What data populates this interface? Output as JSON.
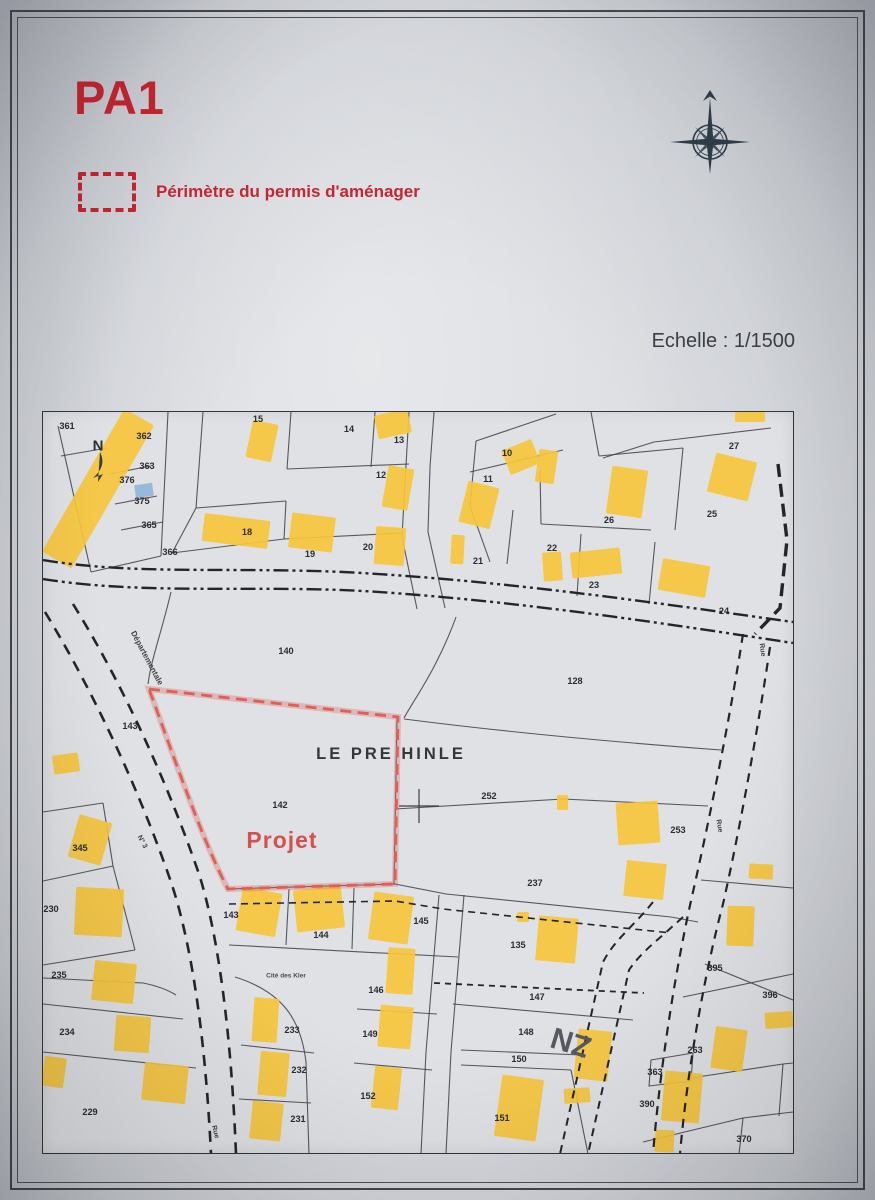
{
  "header": {
    "doc_code": "PA1",
    "legend_label": "Périmètre du permis d'aménager",
    "scale_label": "Echelle : 1/1500",
    "accent": "#c62531"
  },
  "map": {
    "width": 750,
    "height": 741,
    "ink": "#3c3e44",
    "yellow": "#f6c53c",
    "blue": "#8fb6d8",
    "red": "#dd5f57",
    "road_ink": "#24252a",
    "texts": [
      {
        "t": "LE PRE HINLE",
        "x": 348,
        "y": 342,
        "s": 16.5,
        "c": "#34363b",
        "ls": 3
      },
      {
        "t": "Projet",
        "x": 239,
        "y": 428,
        "s": 23,
        "c": "#d5514e",
        "ls": 1
      },
      {
        "t": "ZN",
        "x": 528,
        "y": 630,
        "s": 30,
        "c": "#565962",
        "rot": 197
      },
      {
        "t": "N",
        "x": 55,
        "y": 34,
        "s": 15,
        "c": "#2b2d33"
      },
      {
        "t": "Départementale",
        "x": 104,
        "y": 246,
        "s": 8,
        "c": "#3f4146",
        "rot": 62
      },
      {
        "t": "N° 3",
        "x": 99,
        "y": 430,
        "s": 7,
        "c": "#3f4146",
        "rot": 62
      },
      {
        "t": "Rue",
        "x": 719,
        "y": 238,
        "s": 7,
        "c": "#3f4146",
        "rot": 82
      },
      {
        "t": "Rue",
        "x": 676,
        "y": 414,
        "s": 7,
        "c": "#3f4146",
        "rot": 80
      },
      {
        "t": "Rue",
        "x": 172,
        "y": 720,
        "s": 7,
        "c": "#3f4146",
        "rot": 75
      },
      {
        "t": "Cité des Kler",
        "x": 243,
        "y": 564,
        "s": 6.5,
        "c": "#4a4c52"
      },
      {
        "t": "361",
        "x": 24,
        "y": 14
      },
      {
        "t": "362",
        "x": 101,
        "y": 24
      },
      {
        "t": "363",
        "x": 104,
        "y": 54
      },
      {
        "t": "376",
        "x": 84,
        "y": 68
      },
      {
        "t": "375",
        "x": 99,
        "y": 89
      },
      {
        "t": "365",
        "x": 106,
        "y": 113
      },
      {
        "t": "366",
        "x": 127,
        "y": 140
      },
      {
        "t": "15",
        "x": 215,
        "y": 7
      },
      {
        "t": "14",
        "x": 306,
        "y": 17
      },
      {
        "t": "13",
        "x": 356,
        "y": 28
      },
      {
        "t": "12",
        "x": 338,
        "y": 63
      },
      {
        "t": "10",
        "x": 464,
        "y": 41
      },
      {
        "t": "11",
        "x": 445,
        "y": 67
      },
      {
        "t": "27",
        "x": 691,
        "y": 34
      },
      {
        "t": "26",
        "x": 566,
        "y": 108
      },
      {
        "t": "25",
        "x": 669,
        "y": 102
      },
      {
        "t": "18",
        "x": 204,
        "y": 120
      },
      {
        "t": "19",
        "x": 267,
        "y": 142
      },
      {
        "t": "20",
        "x": 325,
        "y": 135
      },
      {
        "t": "21",
        "x": 435,
        "y": 149
      },
      {
        "t": "22",
        "x": 509,
        "y": 136
      },
      {
        "t": "23",
        "x": 551,
        "y": 173
      },
      {
        "t": "24",
        "x": 681,
        "y": 199
      },
      {
        "t": "140",
        "x": 243,
        "y": 239
      },
      {
        "t": "128",
        "x": 532,
        "y": 269
      },
      {
        "t": "143",
        "x": 87,
        "y": 314
      },
      {
        "t": "142",
        "x": 237,
        "y": 393
      },
      {
        "t": "252",
        "x": 446,
        "y": 384
      },
      {
        "t": "253",
        "x": 635,
        "y": 418
      },
      {
        "t": "345",
        "x": 37,
        "y": 436
      },
      {
        "t": "230",
        "x": 8,
        "y": 497
      },
      {
        "t": "237",
        "x": 492,
        "y": 471
      },
      {
        "t": "135",
        "x": 475,
        "y": 533
      },
      {
        "t": "147",
        "x": 494,
        "y": 585
      },
      {
        "t": "148",
        "x": 483,
        "y": 620
      },
      {
        "t": "150",
        "x": 476,
        "y": 647
      },
      {
        "t": "151",
        "x": 459,
        "y": 706
      },
      {
        "t": "143",
        "x": 188,
        "y": 503
      },
      {
        "t": "144",
        "x": 278,
        "y": 523
      },
      {
        "t": "145",
        "x": 378,
        "y": 509
      },
      {
        "t": "146",
        "x": 333,
        "y": 578
      },
      {
        "t": "149",
        "x": 327,
        "y": 622
      },
      {
        "t": "152",
        "x": 325,
        "y": 684
      },
      {
        "t": "233",
        "x": 249,
        "y": 618
      },
      {
        "t": "232",
        "x": 256,
        "y": 658
      },
      {
        "t": "231",
        "x": 255,
        "y": 707
      },
      {
        "t": "235",
        "x": 16,
        "y": 563
      },
      {
        "t": "234",
        "x": 24,
        "y": 620
      },
      {
        "t": "229",
        "x": 47,
        "y": 700
      },
      {
        "t": "263",
        "x": 652,
        "y": 638
      },
      {
        "t": "363",
        "x": 612,
        "y": 660
      },
      {
        "t": "390",
        "x": 604,
        "y": 692
      },
      {
        "t": "370",
        "x": 701,
        "y": 727
      },
      {
        "t": "395",
        "x": 672,
        "y": 556
      },
      {
        "t": "396",
        "x": 727,
        "y": 583
      }
    ],
    "buildings": [
      [
        38,
        -6,
        34,
        165,
        30
      ],
      [
        206,
        10,
        26,
        38,
        12
      ],
      [
        333,
        0,
        34,
        24,
        -12
      ],
      [
        342,
        55,
        26,
        42,
        10
      ],
      [
        462,
        32,
        32,
        26,
        -22
      ],
      [
        420,
        72,
        32,
        42,
        14
      ],
      [
        692,
        0,
        30,
        10,
        0
      ],
      [
        668,
        45,
        42,
        40,
        14
      ],
      [
        566,
        56,
        36,
        48,
        8
      ],
      [
        160,
        105,
        66,
        28,
        7
      ],
      [
        247,
        103,
        44,
        35,
        7
      ],
      [
        332,
        115,
        30,
        38,
        4
      ],
      [
        408,
        123,
        13,
        29,
        3
      ],
      [
        494,
        38,
        19,
        33,
        8
      ],
      [
        500,
        140,
        19,
        29,
        -4
      ],
      [
        528,
        138,
        50,
        26,
        -6
      ],
      [
        617,
        150,
        48,
        32,
        10
      ],
      [
        10,
        342,
        26,
        19,
        -8
      ],
      [
        30,
        406,
        34,
        44,
        16
      ],
      [
        32,
        476,
        48,
        48,
        3
      ],
      [
        514,
        383,
        11,
        15,
        0
      ],
      [
        574,
        390,
        42,
        42,
        -4
      ],
      [
        582,
        450,
        40,
        36,
        6
      ],
      [
        196,
        478,
        40,
        44,
        10
      ],
      [
        252,
        476,
        48,
        42,
        -6
      ],
      [
        328,
        482,
        40,
        48,
        8
      ],
      [
        344,
        536,
        27,
        46,
        4
      ],
      [
        494,
        505,
        40,
        45,
        5
      ],
      [
        474,
        500,
        12,
        10,
        0
      ],
      [
        336,
        594,
        33,
        42,
        5
      ],
      [
        330,
        655,
        27,
        42,
        6
      ],
      [
        210,
        586,
        25,
        44,
        4
      ],
      [
        216,
        640,
        29,
        44,
        5
      ],
      [
        208,
        690,
        31,
        38,
        6
      ],
      [
        50,
        550,
        42,
        40,
        6
      ],
      [
        72,
        604,
        35,
        36,
        4
      ],
      [
        100,
        652,
        44,
        38,
        6
      ],
      [
        0,
        645,
        22,
        30,
        8
      ],
      [
        455,
        665,
        42,
        62,
        8
      ],
      [
        533,
        618,
        34,
        50,
        6
      ],
      [
        521,
        676,
        26,
        15,
        -4
      ],
      [
        670,
        616,
        32,
        42,
        8
      ],
      [
        620,
        660,
        38,
        50,
        5
      ],
      [
        612,
        718,
        19,
        22,
        3
      ],
      [
        706,
        452,
        24,
        15,
        3
      ],
      [
        684,
        494,
        27,
        40,
        2
      ],
      [
        722,
        600,
        28,
        16,
        -4
      ]
    ],
    "blue_building": [
      92,
      72,
      18,
      13,
      -8
    ],
    "boundaries": [
      "M15,14 L48,160",
      "M125,0 L118,144",
      "M48,160 L118,144",
      "M18,44 L64,36",
      "M66,62 L108,54",
      "M72,92 L114,84",
      "M78,118 L120,110",
      "M160,0 L153,96",
      "M153,96 L129,141",
      "M153,96 L243,89",
      "M248,0 L244,57",
      "M332,0 L328,55",
      "M244,57 L366,52",
      "M243,89 L241,127",
      "M241,127 L359,121",
      "M366,0 L359,125",
      "M359,125 L374,197",
      "M391,0 L387,55",
      "M387,55 L385,120",
      "M385,120 L402,196",
      "M129,141 L241,127",
      "M433,29 L513,2",
      "M433,29 L427,94",
      "M427,94 L447,150",
      "M427,60 L520,38",
      "M548,0 L556,44",
      "M556,44 L640,36",
      "M640,36 L632,118",
      "M560,46 L611,30 L728,16",
      "M497,58 L498,112",
      "M498,112 L608,118",
      "M538,122 L534,184",
      "M612,130 L606,192",
      "M470,98 L464,152",
      "M128,180 C118,222 108,248 105,272",
      "M413,205 C395,255 372,286 361,306",
      "M361,307 C470,321 570,330 678,338",
      "M354,306 L351,472",
      "M352,397 L520,387 L665,394",
      "M183,477 L352,472 L403,482 L628,505 L655,510",
      "M410,592 L590,608",
      "M418,638 L538,643",
      "M418,653 L528,658",
      "M186,533 L415,545",
      "M246,477 L243,533",
      "M311,476 L309,537",
      "M396,483 L383,640 L378,742",
      "M421,483 L408,640 L403,742",
      "M314,597 L394,602",
      "M311,651 L389,658",
      "M192,565 C240,580 258,608 263,650 L266,742",
      "M198,633 L271,641",
      "M196,687 L268,691",
      "M0,400 L60,391",
      "M60,391 L70,454",
      "M0,469 L70,454",
      "M70,454 L92,538",
      "M0,553 L92,538",
      "M0,566 L100,571 C115,574 125,578 133,583",
      "M0,592 L140,607",
      "M0,640 L153,656",
      "M528,658 L545,742",
      "M658,468 L750,476",
      "M662,552 L750,588",
      "M640,585 L750,562",
      "M608,648 L650,641 L648,669 L606,674 Z",
      "M648,666 L740,652 L750,651",
      "M600,730 L700,706 L750,700",
      "M700,706 L696,742",
      "M740,652 L736,704"
    ],
    "roads": [
      {
        "d": "M0,148 C90,163 180,155 300,160 C460,168 620,192 750,210",
        "dash": "15 4 3 4 3 4",
        "w": 2.4
      },
      {
        "d": "M0,167 C100,183 210,173 320,179 C470,188 625,212 750,231",
        "dash": "15 4 3 4 3 4",
        "w": 2.4
      },
      {
        "d": "M2,200 C40,262 90,360 128,470 C148,530 162,620 168,742",
        "dash": "11 8",
        "w": 2.6
      },
      {
        "d": "M30,192 C70,256 118,352 156,462 C175,522 188,618 193,742",
        "dash": "11 8",
        "w": 2.6
      },
      {
        "d": "M700,222 C688,300 668,400 650,480 C635,545 618,645 610,742",
        "dash": "9 7",
        "w": 2.2
      },
      {
        "d": "M727,235 C716,310 698,412 680,492 C664,552 645,650 637,742",
        "dash": "9 7",
        "w": 2.2
      },
      {
        "d": "M610,490 C590,515 572,527 560,550 L517,742",
        "dash": "8 6",
        "w": 2
      },
      {
        "d": "M640,505 C615,528 598,540 586,558 L545,742",
        "dash": "8 6",
        "w": 2
      },
      {
        "d": "M186,492 L352,489 L400,497 L628,521",
        "dash": "7 5",
        "w": 1.6
      },
      {
        "d": "M391,571 L601,581",
        "dash": "6 5",
        "w": 1.8
      },
      {
        "d": "M735,52 L744,128 L737,196 L712,222",
        "dash": "13 7",
        "w": 3.4
      }
    ],
    "red_perimeter": {
      "d": "M106,277 L355,305 L352,472 L185,477 C160,430 132,348 106,277 Z",
      "dash": "11 6.5",
      "w": 2.8
    },
    "cross_marks": [
      "M356,394 L396,394",
      "M376,377 L376,411"
    ],
    "north_arrow": "M57,40 C62,50 59,58 50,66 L60,62 L55,70 Z"
  }
}
